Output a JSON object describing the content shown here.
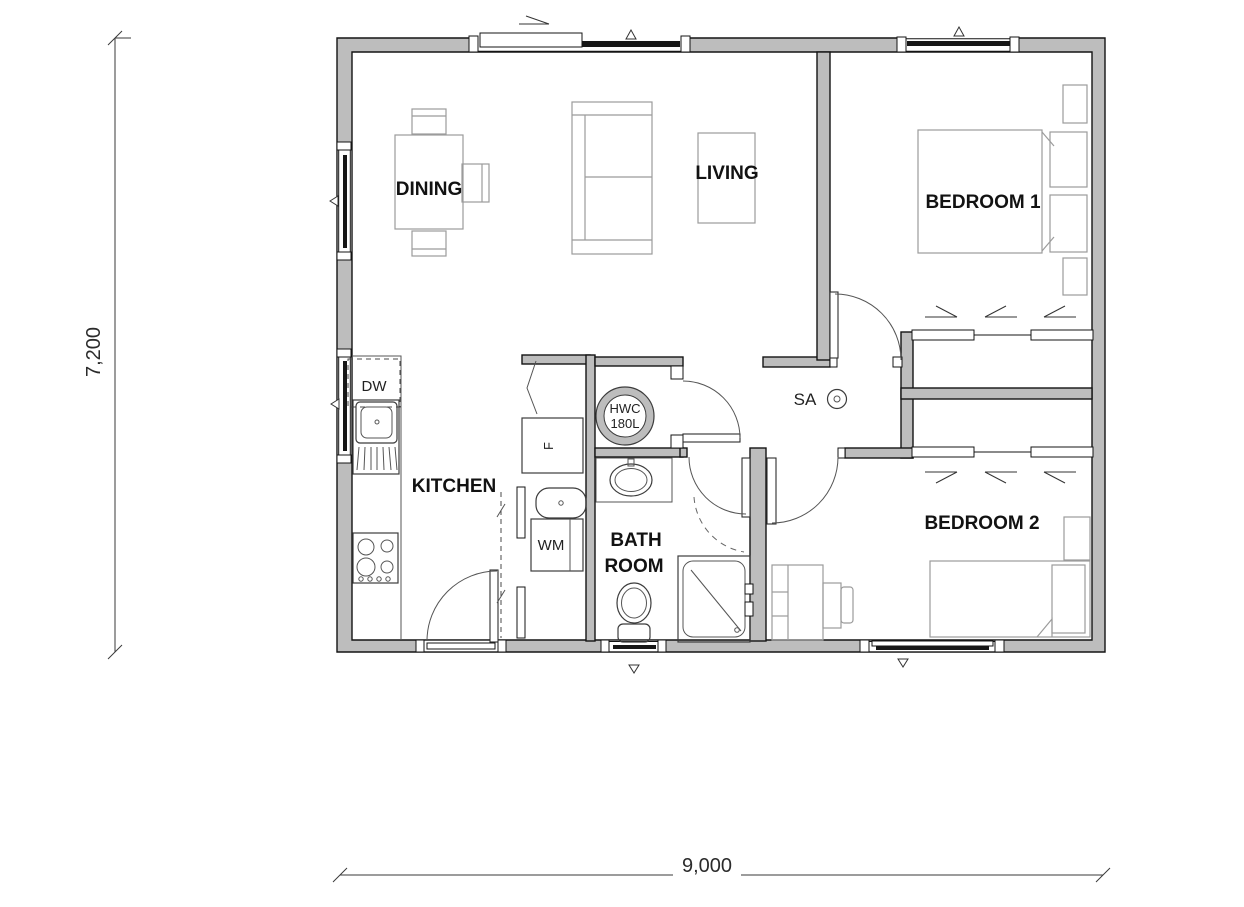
{
  "document": {
    "type": "architectural-floor-plan",
    "bedrooms": 2
  },
  "rooms": {
    "dining": "DINING",
    "living": "LIVING",
    "bedroom1": "BEDROOM 1",
    "bedroom2": "BEDROOM 2",
    "kitchen": "KITCHEN",
    "bathroom_line1": "BATH",
    "bathroom_line2": "ROOM"
  },
  "labels": {
    "dishwasher": "DW",
    "fridge": "F",
    "washing_machine": "WM",
    "hot_water_cylinder_line1": "HWC",
    "hot_water_cylinder_line2": "180L",
    "smoke_alarm": "SA"
  },
  "dimensions": {
    "overall_width": "9,000",
    "overall_depth": "7,200"
  },
  "colors": {
    "background": "#ffffff",
    "wall_fill": "#bdbdbd",
    "wall_outline": "#141414",
    "window_glazing": "#161616",
    "furniture_outline": "#9b9b9b",
    "fixture_outline": "#3c3c3c",
    "label_text": "#121212"
  }
}
